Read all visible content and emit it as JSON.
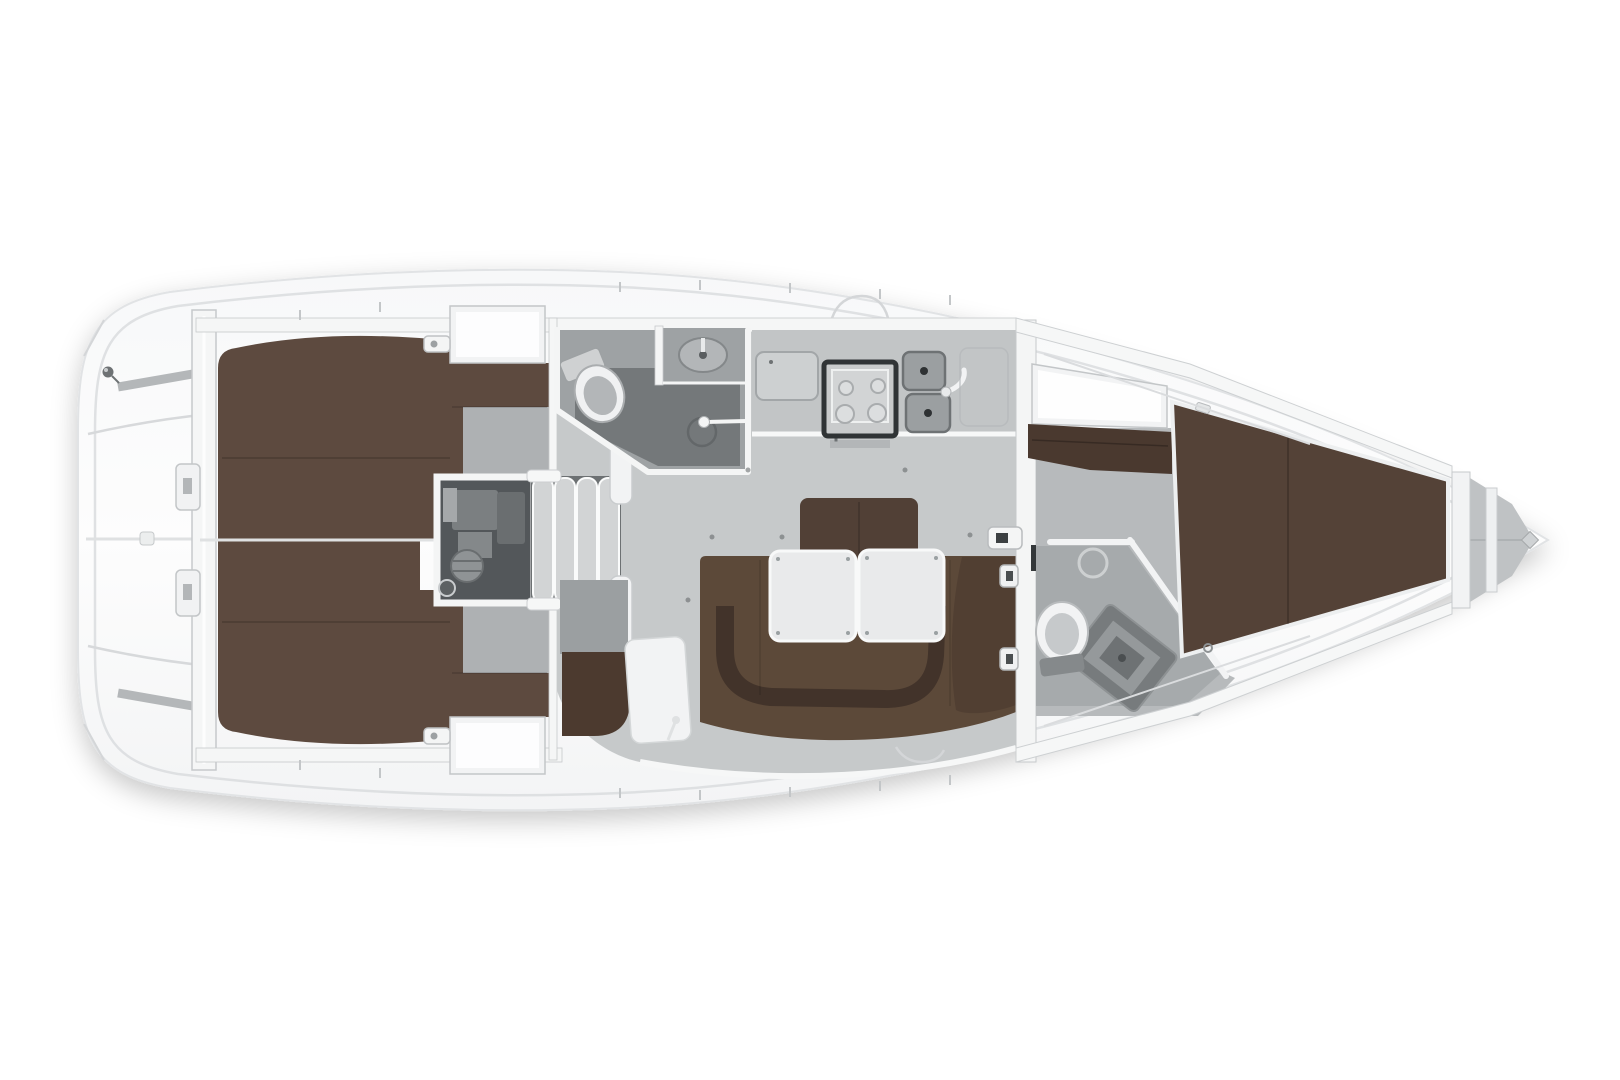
{
  "diagram": {
    "title": "Sailing yacht interior floor plan - top view, bow to the right",
    "type": "floor-plan"
  },
  "colors": {
    "background": "#ffffff",
    "hull": "#fafbfb",
    "hull_outline": "#e1e3e5",
    "deck_line": "#dcdee0",
    "wall": "#f5f6f6",
    "wall_border": "#c6c9cb",
    "floor_salon": "#c6c9ca",
    "floor_cabin": "#aeb1b3",
    "floor_head": "#9ea2a4",
    "shower": "#74787a",
    "berth_aft": "#5d4a3f",
    "berth_fwd": "#544237",
    "settee": "#5c4939",
    "settee_dark": "#42332a",
    "backrest": "#514036",
    "shelf": "#4a392f",
    "nav_seat": "#4c3a2f",
    "table": "#e9eaeb",
    "engine_bay": "#53575a",
    "machinery": "#7b7f81",
    "steps": "#d2d4d5",
    "steps_gap": "#6d7173",
    "fixture_white": "#f2f3f4",
    "fixture_gray": "#c6c9cb",
    "stove_frame": "#303436",
    "sink": "#9b9fa1",
    "locker_gray": "#bfc2c4",
    "strip_gray": "#b4b7b9"
  },
  "rooms": [
    {
      "id": "stern-platform",
      "fixtures": [
        "transom-seat-strips",
        "deck-fitting",
        "steering-rod"
      ]
    },
    {
      "id": "aft-cabin-port",
      "fixtures": [
        "double-berth",
        "wet-locker",
        "cabin-floor",
        "latch"
      ]
    },
    {
      "id": "aft-cabin-starboard",
      "fixtures": [
        "double-berth",
        "wet-locker",
        "cabin-floor",
        "latch"
      ]
    },
    {
      "id": "engine-room",
      "fixtures": [
        "engine",
        "companionway-steps"
      ]
    },
    {
      "id": "aft-head",
      "fixtures": [
        "toilet",
        "washbasin",
        "shower-head"
      ]
    },
    {
      "id": "galley",
      "fixtures": [
        "icebox-lid",
        "gimbaled-stove",
        "double-sink",
        "faucet",
        "locker"
      ]
    },
    {
      "id": "salon",
      "fixtures": [
        "u-shaped-settee",
        "backrest",
        "folding-table-left",
        "folding-table-right",
        "nav-seat",
        "chart-table"
      ]
    },
    {
      "id": "forward-head",
      "fixtures": [
        "toilet",
        "washbasin",
        "shower-tray"
      ]
    },
    {
      "id": "forward-cabin",
      "fixtures": [
        "v-berth",
        "wardrobe",
        "shelf"
      ]
    },
    {
      "id": "anchor-locker",
      "fixtures": [
        "bow-partitions",
        "forestay-fitting"
      ]
    }
  ]
}
